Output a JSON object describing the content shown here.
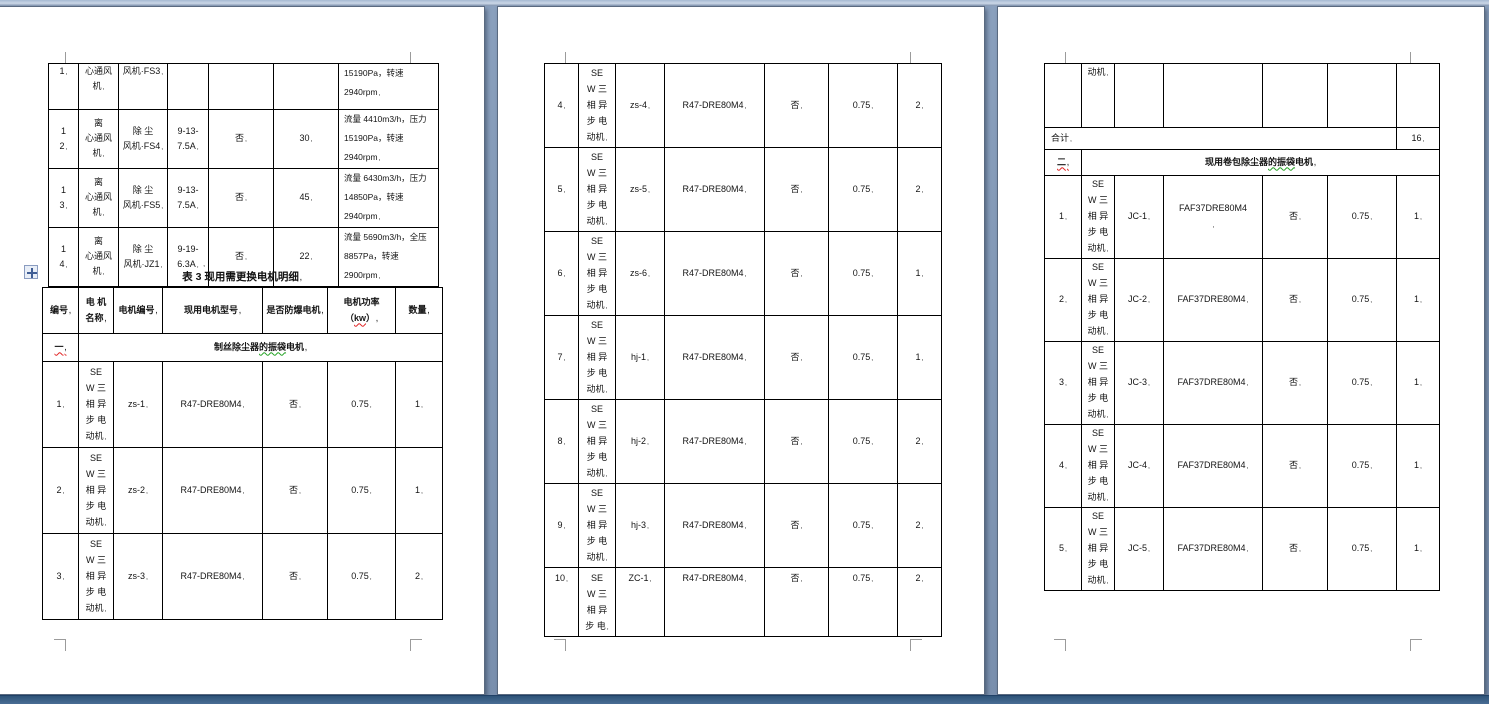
{
  "pages": [
    {
      "top_table": {
        "rows": [
          {
            "no": "1",
            "name": "心通风\n机",
            "code": "风机·FS3",
            "spec": "",
            "flag": "",
            "power": "",
            "remark": "15190Pa，转速 2940rpm"
          },
          {
            "no": "1\n2",
            "name": "离\n心通风\n机",
            "code": "除 尘\n风机·FS4",
            "spec": "9-13-7.5A",
            "flag": "否",
            "power": "30",
            "remark": "流量 4410m3/h，压力\n15190Pa，转速 2940rpm"
          },
          {
            "no": "1\n3",
            "name": "离\n心通风\n机",
            "code": "除 尘\n风机·FS5",
            "spec": "9-13-7.5A",
            "flag": "否",
            "power": "45",
            "remark": "流量 6430m3/h，压力\n14850Pa，转速 2940rpm"
          },
          {
            "no": "1\n4",
            "name": "离\n心通风\n机",
            "code": "除 尘\n风机·JZ1",
            "spec": "9-19-6.3A",
            "flag": "否",
            "power": "22",
            "remark": "流量 5690m3/h，全压\n8857Pa，转速 2900rpm"
          }
        ]
      },
      "table3_title": "表 3 现用需更换电机明细",
      "main_table": {
        "headers": {
          "no": "编号",
          "name": "电 机\n名称",
          "code": "电机编号",
          "model": "现用电机型号",
          "flag": "是否防爆电机",
          "power_prefix": "电机功率（",
          "power_kw": "kw",
          "power_suffix": "）",
          "qty": "数量"
        },
        "section_index": "一",
        "section_title_pre": "制丝除尘器",
        "section_title_mid": "的振袋",
        "section_title_post": "电机",
        "rows": [
          {
            "no": "1",
            "name": "SE\nW 三\n相 异\n步 电\n动机",
            "code": "zs-1",
            "model": "R47-DRE80M4",
            "flag": "否",
            "power": "0.75",
            "qty": "1"
          },
          {
            "no": "2",
            "name": "SE\nW 三\n相 异\n步 电\n动机",
            "code": "zs-2",
            "model": "R47-DRE80M4",
            "flag": "否",
            "power": "0.75",
            "qty": "1"
          },
          {
            "no": "3",
            "name": "SE\nW 三\n相 异\n步 电\n动机",
            "code": "zs-3",
            "model": "R47-DRE80M4",
            "flag": "否",
            "power": "0.75",
            "qty": "2"
          }
        ]
      }
    },
    {
      "table": {
        "rows": [
          {
            "no": "4",
            "name": "SE\nW 三\n相 异\n步 电\n动机",
            "code": "zs-4",
            "model": "R47-DRE80M4",
            "flag": "否",
            "power": "0.75",
            "qty": "2"
          },
          {
            "no": "5",
            "name": "SE\nW 三\n相 异\n步 电\n动机",
            "code": "zs-5",
            "model": "R47-DRE80M4",
            "flag": "否",
            "power": "0.75",
            "qty": "2"
          },
          {
            "no": "6",
            "name": "SE\nW 三\n相 异\n步 电\n动机",
            "code": "zs-6",
            "model": "R47-DRE80M4",
            "flag": "否",
            "power": "0.75",
            "qty": "1"
          },
          {
            "no": "7",
            "name": "SE\nW 三\n相 异\n步 电\n动机",
            "code": "hj-1",
            "model": "R47-DRE80M4",
            "flag": "否",
            "power": "0.75",
            "qty": "1"
          },
          {
            "no": "8",
            "name": "SE\nW 三\n相 异\n步 电\n动机",
            "code": "hj-2",
            "model": "R47-DRE80M4",
            "flag": "否",
            "power": "0.75",
            "qty": "2"
          },
          {
            "no": "9",
            "name": "SE\nW 三\n相 异\n步 电\n动机",
            "code": "hj-3",
            "model": "R47-DRE80M4",
            "flag": "否",
            "power": "0.75",
            "qty": "2"
          },
          {
            "no": "10",
            "name": "SE\nW 三\n相 异\n步 电",
            "code": "ZC-1",
            "model": "R47-DRE80M4",
            "flag": "否",
            "power": "0.75",
            "qty": "2"
          }
        ]
      }
    },
    {
      "table": {
        "continuation_name": "动机",
        "total_label": "合计",
        "total_value": "16",
        "section_index": "二",
        "section_title_pre": "现用卷包除尘器",
        "section_title_mid": "的振袋",
        "section_title_post": "电机",
        "rows": [
          {
            "no": "1",
            "name": "SE\nW 三\n相 异\n步 电\n动机",
            "code": "JC-1",
            "model": "FAF37DRE80M4\n",
            "flag": "否",
            "power": "0.75",
            "qty": "1"
          },
          {
            "no": "2",
            "name": "SE\nW 三\n相 异\n步 电\n动机",
            "code": "JC-2",
            "model": "FAF37DRE80M4",
            "flag": "否",
            "power": "0.75",
            "qty": "1"
          },
          {
            "no": "3",
            "name": "SE\nW 三\n相 异\n步 电\n动机",
            "code": "JC-3",
            "model": "FAF37DRE80M4",
            "flag": "否",
            "power": "0.75",
            "qty": "1"
          },
          {
            "no": "4",
            "name": "SE\nW 三\n相 异\n步 电\n动机",
            "code": "JC-4",
            "model": "FAF37DRE80M4",
            "flag": "否",
            "power": "0.75",
            "qty": "1"
          },
          {
            "no": "5",
            "name": "SE\nW 三\n相 异\n步 电\n动机",
            "code": "JC-5",
            "model": "FAF37DRE80M4",
            "flag": "否",
            "power": "0.75",
            "qty": "1"
          }
        ]
      }
    }
  ]
}
